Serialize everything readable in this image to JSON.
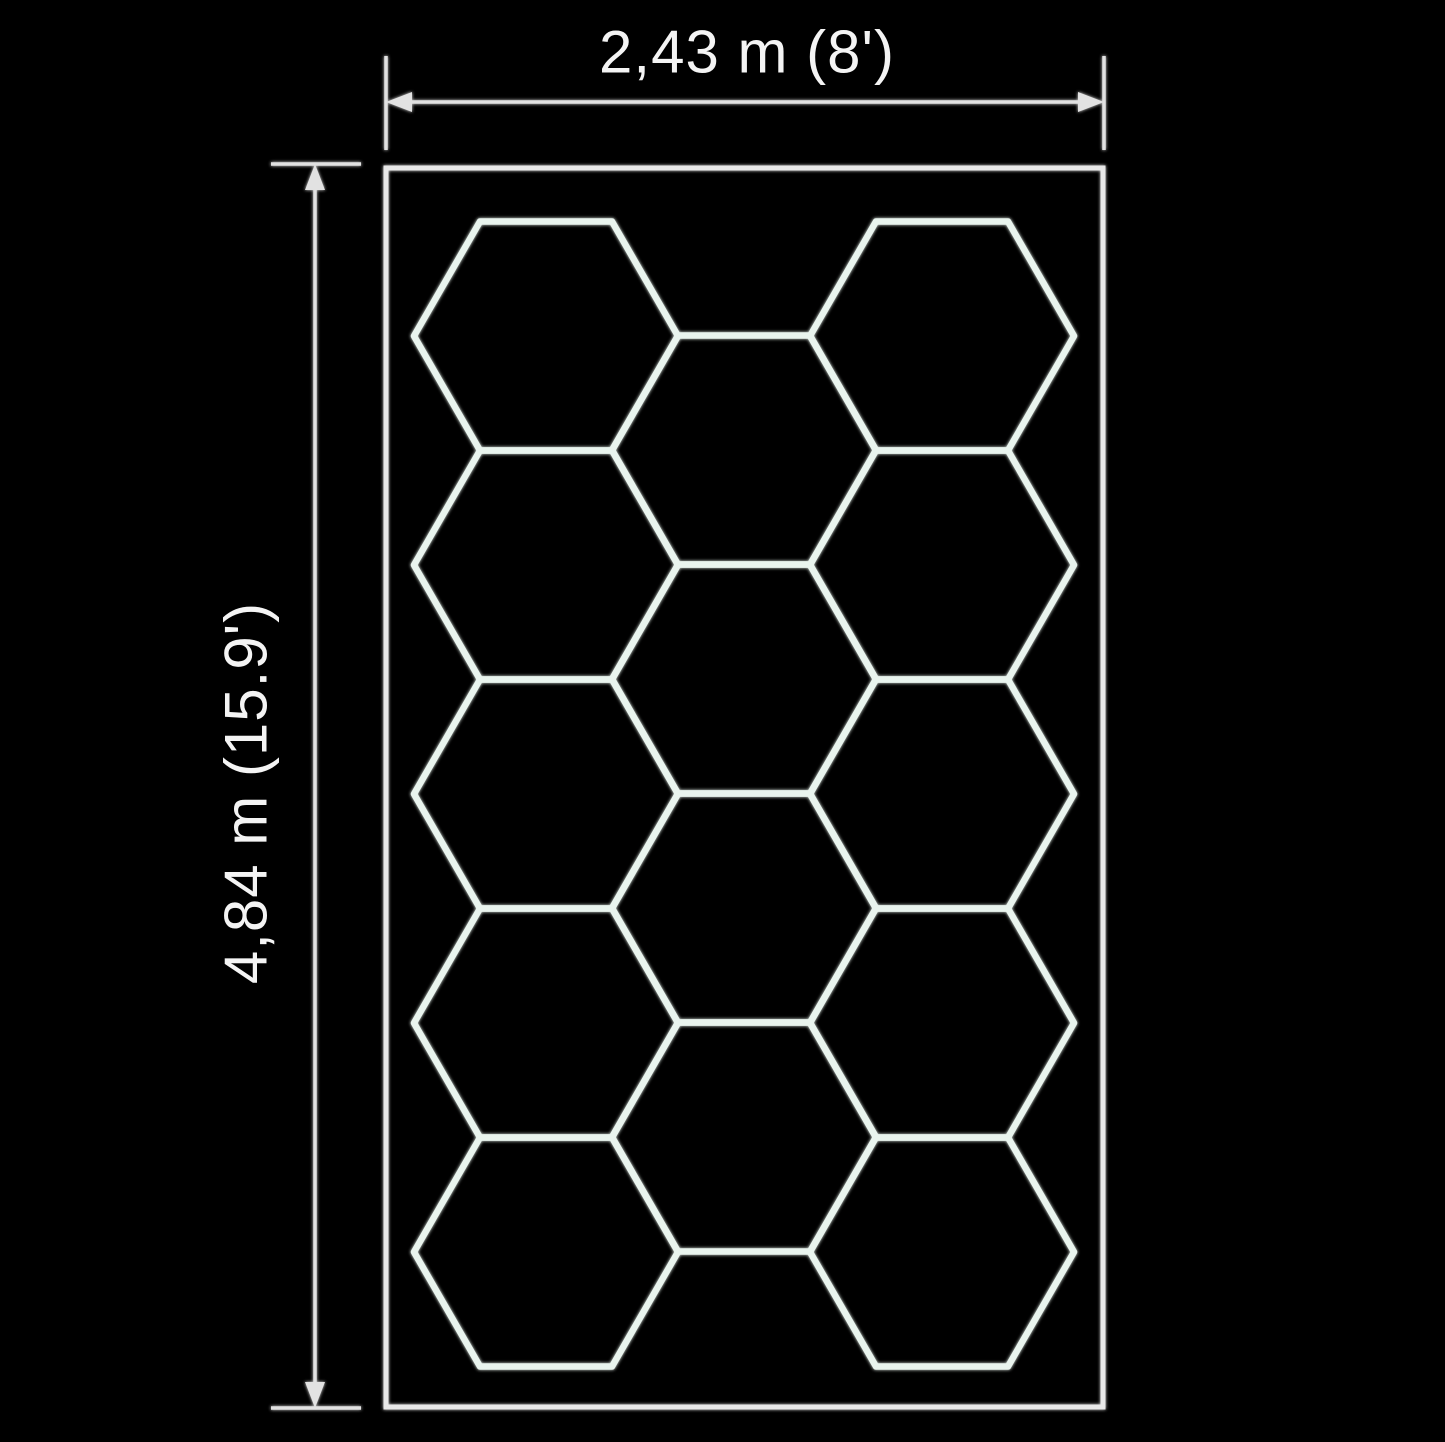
{
  "diagram": {
    "title": "hexagon-grid-panel-dimension-drawing",
    "background_color": "#000000",
    "panel": {
      "x": 386,
      "y": 168,
      "width": 717,
      "height": 1239,
      "stroke_color": "#e8e8e8",
      "stroke_width": 5
    },
    "hex_grid": {
      "stroke_color": "#e9f4ee",
      "stroke_width": 6.5,
      "hex_point_radius": 132,
      "hex_height": 229,
      "total_hexagons": 14,
      "columns": [
        {
          "cx": 546,
          "centers_y": [
            336,
            565,
            794,
            1023,
            1252
          ]
        },
        {
          "cx": 744,
          "centers_y": [
            450,
            679,
            908,
            1137
          ]
        },
        {
          "cx": 942,
          "centers_y": [
            336,
            565,
            794,
            1023,
            1252
          ]
        }
      ]
    },
    "width_dim": {
      "label": "2,43 m (8')",
      "line_y": 102,
      "x1": 386,
      "x2": 1104,
      "ext_y1": 56,
      "ext_y2": 150,
      "label_x": 747,
      "label_y": 52
    },
    "height_dim": {
      "label": "4,84 m (15.9')",
      "line_x": 315,
      "y1": 164,
      "y2": 1408,
      "ext_x1": 271,
      "ext_x2": 361,
      "label_x": 246,
      "label_y": 793
    },
    "dim_style": {
      "stroke_color": "#e2e2e2",
      "stroke_width": 3.5,
      "arrow_length": 26,
      "arrow_half_width": 10,
      "text_color": "#f4f4f4",
      "font_size": 60
    }
  }
}
